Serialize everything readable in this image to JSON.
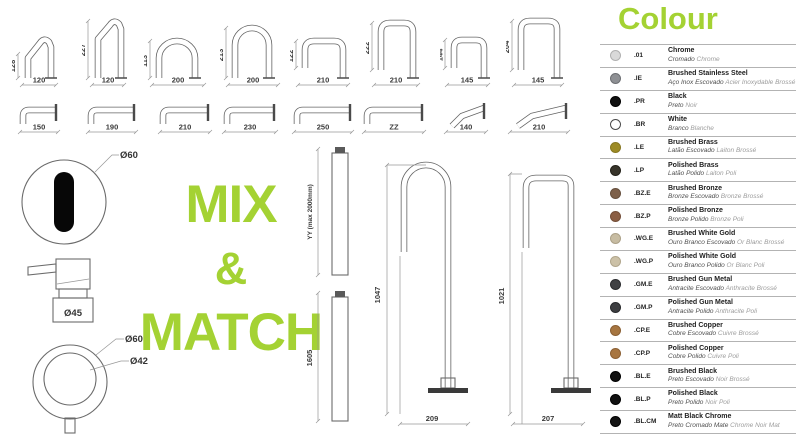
{
  "accent_green": "#a4d233",
  "mix_match": {
    "line1": "MIX",
    "line2": "&",
    "line3": "MATCH"
  },
  "deck_spouts": [
    {
      "height": "128",
      "width": "120"
    },
    {
      "height": "227",
      "width": "120"
    },
    {
      "height": "113",
      "width": "200"
    },
    {
      "height": "213",
      "width": "200"
    },
    {
      "height": "122",
      "width": "210"
    },
    {
      "height": "222",
      "width": "210"
    },
    {
      "height": "144",
      "width": "145"
    },
    {
      "height": "204",
      "width": "145"
    }
  ],
  "wall_spouts": [
    {
      "length": "150"
    },
    {
      "length": "190"
    },
    {
      "length": "210"
    },
    {
      "length": "230"
    },
    {
      "length": "250"
    },
    {
      "length": "ZZ"
    },
    {
      "length": "140"
    },
    {
      "length": "210"
    }
  ],
  "risers": [
    {
      "label": "YY (max 2000mm)"
    },
    {
      "label": "1605"
    }
  ],
  "floor_spouts": [
    {
      "height": "1047",
      "base": "209"
    },
    {
      "height": "1021",
      "base": "207"
    }
  ],
  "details": {
    "sensor_diameter": "Ø60",
    "mixer_base_diameter": "Ø45",
    "handle_outer_diameter": "Ø60",
    "handle_inner_diameter": "Ø42"
  },
  "colour_legend": {
    "title": "Colour",
    "rows": [
      {
        "code": ".01",
        "name": "Chrome",
        "pt": "Cromado",
        "fr": "Chrome",
        "swatch": "#d9d9d9",
        "border": "#b0b0b0"
      },
      {
        "code": ".IE",
        "name": "Brushed Stainless Steel",
        "pt": "Aço Inox Escovado",
        "fr": "Acier Inoxydable Brossé",
        "swatch": "#8e9094",
        "border": "#6d6f73"
      },
      {
        "code": ".PR",
        "name": "Black",
        "pt": "Preto",
        "fr": "Noir",
        "swatch": "#101010",
        "border": "#000000"
      },
      {
        "code": ".BR",
        "name": "White",
        "pt": "Branco",
        "fr": "Blanche",
        "swatch": "#ffffff",
        "border": "#4a4a4a"
      },
      {
        "code": ".LE",
        "name": "Brushed Brass",
        "pt": "Latão Escovado",
        "fr": "Laiton Brossé",
        "swatch": "#9d8b25",
        "border": "#877721"
      },
      {
        "code": ".LP",
        "name": "Polished Brass",
        "pt": "Latão Polido",
        "fr": "Laiton Poli",
        "swatch": "#37342a",
        "border": "#232119"
      },
      {
        "code": ".BZ.E",
        "name": "Brushed Bronze",
        "pt": "Bronze Escovado",
        "fr": "Bronze Brossé",
        "swatch": "#7d604a",
        "border": "#66503e"
      },
      {
        "code": ".BZ.P",
        "name": "Polished Bronze",
        "pt": "Bronze Polido",
        "fr": "Bronze Poli",
        "swatch": "#8a5e43",
        "border": "#734e38"
      },
      {
        "code": ".WG.E",
        "name": "Brushed White Gold",
        "pt": "Ouro Branco Escovado",
        "fr": "Or Blanc Brossé",
        "swatch": "#c7bca2",
        "border": "#aca188"
      },
      {
        "code": ".WG.P",
        "name": "Polished White Gold",
        "pt": "Ouro Branco Polido",
        "fr": "Or Blanc Poli",
        "swatch": "#ccc1a7",
        "border": "#b1a68c"
      },
      {
        "code": ".GM.E",
        "name": "Brushed Gun Metal",
        "pt": "Antracite Escovado",
        "fr": "Anthracite Brossé",
        "swatch": "#404144",
        "border": "#2b2c2f"
      },
      {
        "code": ".GM.P",
        "name": "Polished Gun Metal",
        "pt": "Antracite Polido",
        "fr": "Anthracite Poli",
        "swatch": "#3d3e41",
        "border": "#28292c"
      },
      {
        "code": ".CP.E",
        "name": "Brushed Copper",
        "pt": "Cobre Escovado",
        "fr": "Cuivre Brossé",
        "swatch": "#a67540",
        "border": "#8a5f33"
      },
      {
        "code": ".CP.P",
        "name": "Polished Copper",
        "pt": "Cobre Polido",
        "fr": "Cuivre Poli",
        "swatch": "#a87641",
        "border": "#8c6034"
      },
      {
        "code": ".BL.E",
        "name": "Brushed Black",
        "pt": "Preto Escovado",
        "fr": "Noir Brossé",
        "swatch": "#111111",
        "border": "#000000"
      },
      {
        "code": ".BL.P",
        "name": "Polished Black",
        "pt": "Preto Polido",
        "fr": "Noir Poli",
        "swatch": "#111111",
        "border": "#000000"
      },
      {
        "code": ".BL.CM",
        "name": "Matt Black Chrome",
        "pt": "Preto Cromado Mate",
        "fr": "Chrome Noir Mat",
        "swatch": "#141414",
        "border": "#000000"
      }
    ]
  }
}
